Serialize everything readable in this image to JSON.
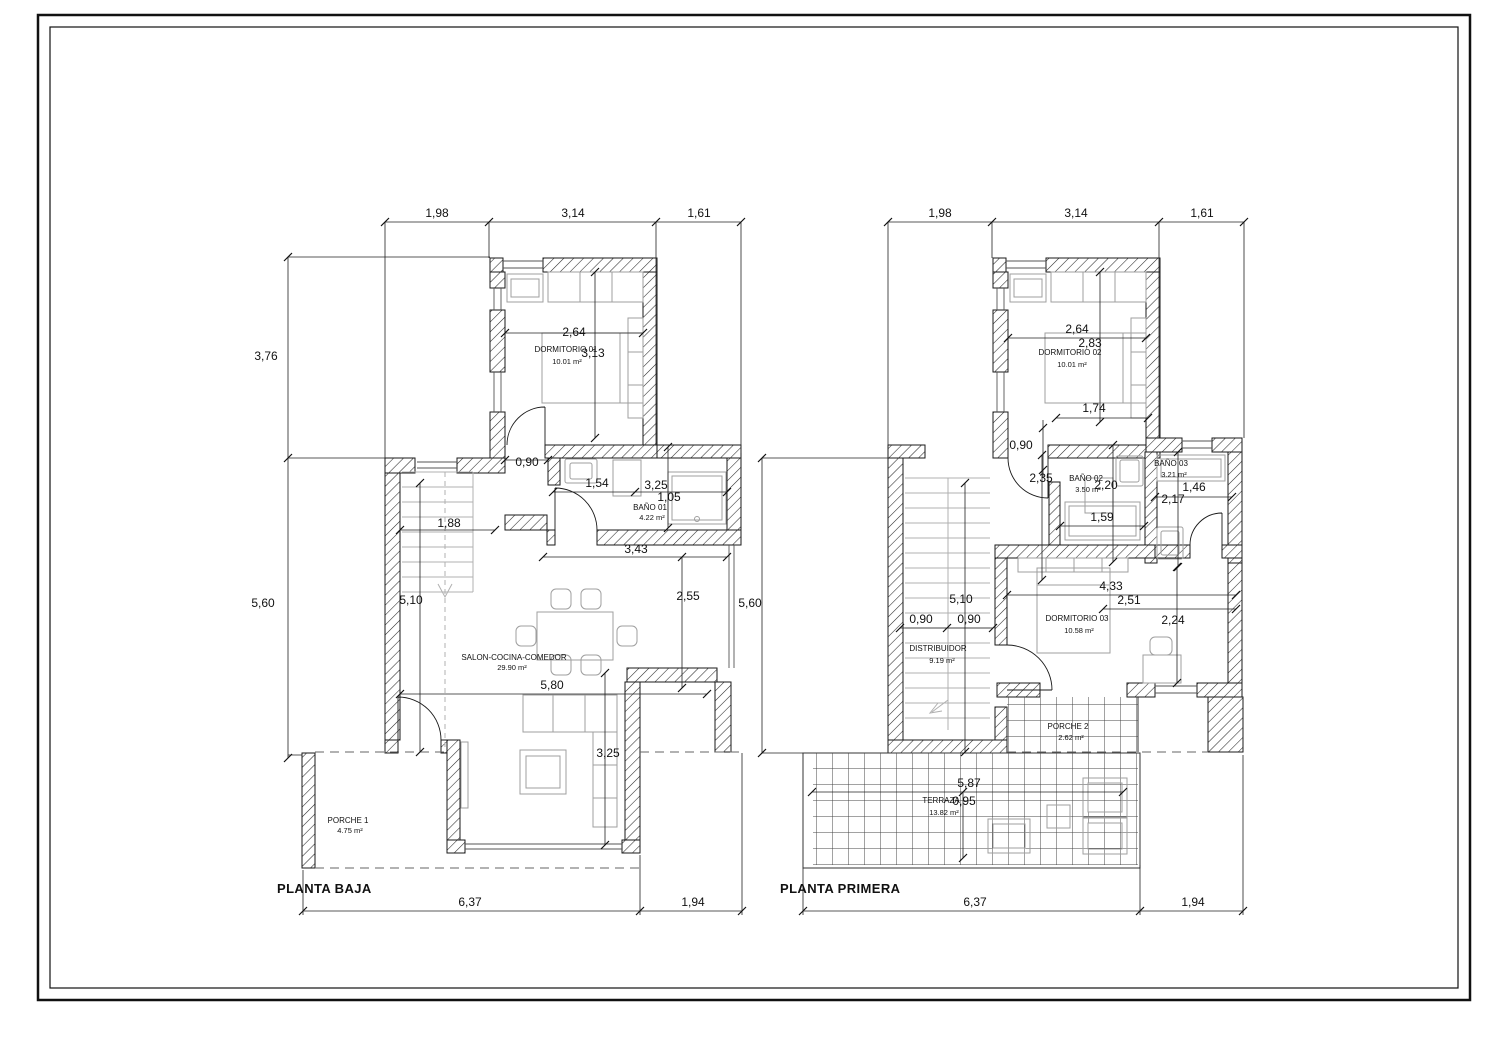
{
  "colors": {
    "background": "#ffffff",
    "line": "#1a1a1a",
    "furniture": "#9f9f9f",
    "stairs": "#b0b0b0",
    "dashed": "#666666"
  },
  "baja": {
    "title": "PLANTA BAJA",
    "top": [
      "1,98",
      "3,14",
      "1,61"
    ],
    "left": [
      "3,76",
      "5,60"
    ],
    "bottom": [
      "6,37",
      "1,94"
    ],
    "i": {
      "w264": "2,64",
      "h313": "3,13",
      "d090": "0,90",
      "w154": "1,54",
      "w325": "3,25",
      "h105": "1,05",
      "w188": "1,88",
      "h510": "5,10",
      "w343": "3,43",
      "h255": "2,55",
      "w580": "5,80",
      "h325": "3,25"
    },
    "rooms": {
      "dorm1": {
        "name": "DORMITORIO 01",
        "area": "10.01 m²"
      },
      "bano1": {
        "name": "BAÑO 01",
        "area": "4.22 m²"
      },
      "salon": {
        "name": "SALON-COCINA-COMEDOR",
        "area": "29.90 m²"
      },
      "porche1": {
        "name": "PORCHE 1",
        "area": "4.75 m²"
      }
    }
  },
  "primera": {
    "title": "PLANTA PRIMERA",
    "top": [
      "1,98",
      "3,14",
      "1,61"
    ],
    "left": [
      "5,60"
    ],
    "bottom": [
      "6,37",
      "1,94"
    ],
    "i": {
      "w264": "2,64",
      "h283": "2,83",
      "w174": "1,74",
      "d090": "0,90",
      "h235": "2,35",
      "h220": "2,20",
      "w146": "1,46",
      "h217": "2,17",
      "w159": "1,59",
      "w433": "4,33",
      "w251": "2,51",
      "h224": "2,24",
      "h510": "5,10",
      "f1": "0,90",
      "f2": "0,90",
      "w587": "5,87",
      "h095": "0,95"
    },
    "rooms": {
      "dorm2": {
        "name": "DORMITORIO 02",
        "area": "10.01 m²"
      },
      "bano2": {
        "name": "BAÑO 02",
        "area": "3.50 m²"
      },
      "bano3": {
        "name": "BAÑO 03",
        "area": "3.21 m²"
      },
      "dorm3": {
        "name": "DORMITORIO 03",
        "area": "10.58 m²"
      },
      "distribuidor": {
        "name": "DISTRIBUIDOR",
        "area": "9.19 m²"
      },
      "porche2": {
        "name": "PORCHE 2",
        "area": "2.62 m²"
      },
      "terraza": {
        "name": "TERRAZA",
        "area": "13.82 m²"
      }
    }
  }
}
